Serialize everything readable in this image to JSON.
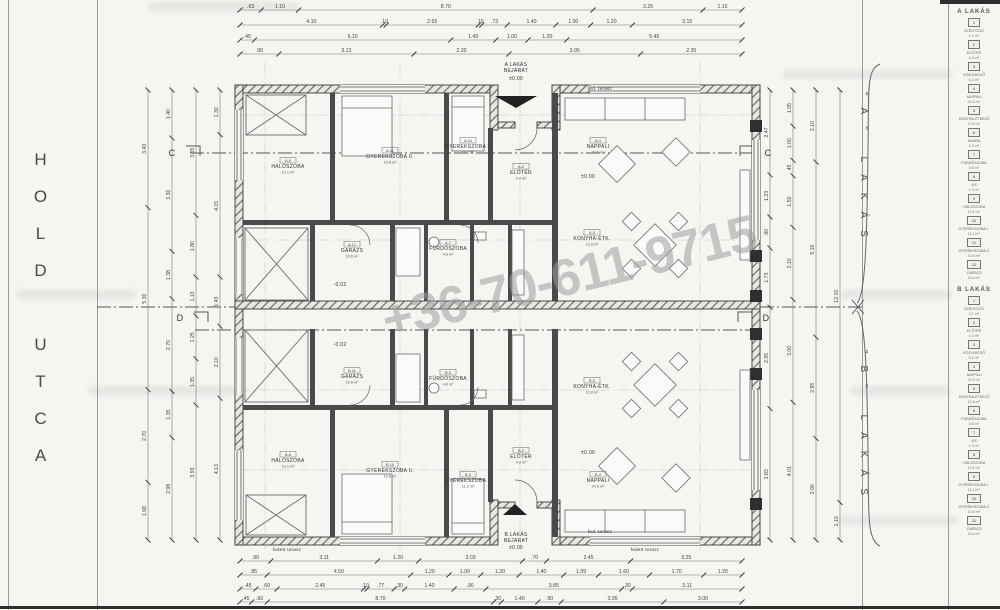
{
  "street": {
    "label": "HOLD UTCA"
  },
  "watermark": {
    "phone": "+36-70-611-9715"
  },
  "units": {
    "a_brace": "\"A\" LAKÁS",
    "b_brace": "\"B\" LAKÁS"
  },
  "legend": {
    "a_header": "A LAKÁS",
    "b_header": "B LAKÁS",
    "a_items": [
      {
        "no": "1",
        "name": "SZÉLFOGÓ",
        "area": "2.1 m²"
      },
      {
        "no": "2",
        "name": "ELŐTÉR",
        "area": "4.3 m²"
      },
      {
        "no": "3",
        "name": "KÖZLEKEDŐ",
        "area": "6.2 m²"
      },
      {
        "no": "4",
        "name": "NAPPALI",
        "area": "24.5 m²"
      },
      {
        "no": "5",
        "name": "KONYHA-ÉTKEZŐ",
        "area": "12.8 m²"
      },
      {
        "no": "6",
        "name": "KAMRA",
        "area": "1.5 m²"
      },
      {
        "no": "7",
        "name": "FÜRDŐSZOBA",
        "area": "4.6 m²"
      },
      {
        "no": "8",
        "name": "WC",
        "area": "1.5 m²"
      },
      {
        "no": "9",
        "name": "HÁLÓSZOBA",
        "area": "13.1 m²"
      },
      {
        "no": "10",
        "name": "GYEREKSZOBA I.",
        "area": "11.2 m²"
      },
      {
        "no": "11",
        "name": "GYEREKSZOBA II.",
        "area": "10.8 m²"
      },
      {
        "no": "12",
        "name": "GARÁZS",
        "area": "19.6 m²"
      }
    ],
    "b_items": [
      {
        "no": "1",
        "name": "SZÉLFOGÓ",
        "area": "2.1 m²"
      },
      {
        "no": "2",
        "name": "ELŐTÉR",
        "area": "4.3 m²"
      },
      {
        "no": "3",
        "name": "KÖZLEKEDŐ",
        "area": "6.2 m²"
      },
      {
        "no": "4",
        "name": "NAPPALI",
        "area": "24.5 m²"
      },
      {
        "no": "5",
        "name": "KONYHA-ÉTKEZŐ",
        "area": "12.8 m²"
      },
      {
        "no": "6",
        "name": "FÜRDŐSZOBA",
        "area": "4.6 m²"
      },
      {
        "no": "7",
        "name": "WC",
        "area": "1.5 m²"
      },
      {
        "no": "8",
        "name": "HÁLÓSZOBA",
        "area": "13.1 m²"
      },
      {
        "no": "9",
        "name": "GYEREKSZOBA I.",
        "area": "11.2 m²"
      },
      {
        "no": "10",
        "name": "GYEREKSZOBA II.",
        "area": "10.8 m²"
      },
      {
        "no": "11",
        "name": "GARÁZS",
        "area": "19.6 m²"
      }
    ]
  },
  "plan_texts": [
    {
      "name": "A LAKÁS",
      "x": 516,
      "y": 66
    },
    {
      "name": "BEJÁRAT",
      "x": 516,
      "y": 72
    },
    {
      "name": "±0.00",
      "x": 516,
      "y": 80
    },
    {
      "name": "B LAKÁS",
      "x": 516,
      "y": 536
    },
    {
      "name": "BEJÁRAT",
      "x": 516,
      "y": 542
    },
    {
      "name": "±0.00",
      "x": 516,
      "y": 549
    },
    {
      "num": "A-9",
      "name": "HÁLÓSZOBA",
      "sub": "13.1 m²",
      "x": 288,
      "y": 168
    },
    {
      "num": "A-11",
      "name": "GYEREKSZOBA II.",
      "sub": "10.8 m²",
      "x": 390,
      "y": 158
    },
    {
      "num": "A-10",
      "name": "GYEREKSZOBA I.",
      "sub": "11.2 m²",
      "x": 468,
      "y": 148
    },
    {
      "num": "A-2",
      "name": "ELŐTÉR",
      "sub": "4.3 m²",
      "x": 521,
      "y": 174
    },
    {
      "num": "A-4",
      "name": "NAPPALI",
      "sub": "24.5 m²",
      "x": 598,
      "y": 148
    },
    {
      "num": "A-12",
      "name": "GARÁZS",
      "sub": "19.6 m²",
      "x": 352,
      "y": 252
    },
    {
      "num": "A-7",
      "name": "FÜRDŐSZOBA",
      "sub": "4.6 m²",
      "x": 448,
      "y": 250
    },
    {
      "num": "A-5",
      "name": "KONYHA-ÉTK.",
      "sub": "12.8 m²",
      "x": 592,
      "y": 240
    },
    {
      "name": "±0.00",
      "x": 588,
      "y": 178
    },
    {
      "name": "-0.02",
      "x": 340,
      "y": 286
    },
    {
      "num": "B-8",
      "name": "HÁLÓSZOBA",
      "sub": "13.1 m²",
      "x": 288,
      "y": 462
    },
    {
      "num": "B-10",
      "name": "GYEREKSZOBA II.",
      "sub": "10.8 m²",
      "x": 390,
      "y": 472
    },
    {
      "num": "B-9",
      "name": "GYEREKSZOBA I.",
      "sub": "11.2 m²",
      "x": 468,
      "y": 482
    },
    {
      "num": "B-2",
      "name": "ELŐTÉR",
      "sub": "4.3 m²",
      "x": 521,
      "y": 458
    },
    {
      "num": "B-4",
      "name": "NAPPALI",
      "sub": "24.5 m²",
      "x": 598,
      "y": 482
    },
    {
      "num": "B-11",
      "name": "GARÁZS",
      "sub": "19.6 m²",
      "x": 352,
      "y": 378
    },
    {
      "num": "B-6",
      "name": "FÜRDŐSZOBA",
      "sub": "4.6 m²",
      "x": 448,
      "y": 380
    },
    {
      "num": "B-5",
      "name": "KONYHA-ÉTK.",
      "sub": "12.8 m²",
      "x": 592,
      "y": 388
    },
    {
      "name": "±0.00",
      "x": 588,
      "y": 454
    },
    {
      "name": "-0.02",
      "x": 340,
      "y": 346
    },
    {
      "name": "fed. terasz",
      "x": 600,
      "y": 90,
      "fs": 4.5
    },
    {
      "name": "fed. terasz",
      "x": 600,
      "y": 533,
      "fs": 4.5
    },
    {
      "name": "fedett terasz",
      "x": 287,
      "y": 551,
      "fs": 4.5
    },
    {
      "name": "fedett terasz",
      "x": 645,
      "y": 551,
      "fs": 4.5
    },
    {
      "name": "C",
      "x": 172,
      "y": 156,
      "fs": 9
    },
    {
      "name": "C",
      "x": 768,
      "y": 156,
      "fs": 9
    },
    {
      "name": "D",
      "x": 180,
      "y": 321,
      "fs": 9
    },
    {
      "name": "D",
      "x": 766,
      "y": 321,
      "fs": 9
    }
  ],
  "dimensions": {
    "top": {
      "x0": 240,
      "x1": 742,
      "rows": [
        {
          "y": 10,
          "values": [
            ".63",
            "1.10",
            "8.70",
            "3.25",
            "1.15"
          ]
        },
        {
          "y": 25,
          "values": [
            "4.10",
            ".10",
            "2.65",
            ".10",
            ".73",
            "1.40",
            "1.00",
            "1.20",
            "3.15"
          ]
        },
        {
          "y": 40,
          "values": [
            ".45",
            "6.10",
            "1.40",
            "1.00",
            "1.20",
            "5.45"
          ]
        },
        {
          "y": 54,
          "values": [
            ".90",
            "3.13",
            "2.20",
            "3.05",
            "2.35"
          ]
        }
      ]
    },
    "bottom": {
      "x0": 240,
      "x1": 742,
      "rows": [
        {
          "y": 561,
          "values": [
            ".90",
            "3.11",
            "1.20",
            "3.03",
            ".70",
            "2.45",
            "3.25"
          ]
        },
        {
          "y": 575,
          "values": [
            ".85",
            "4.50",
            "1.20",
            "1.00",
            "1.20",
            "1.40",
            "1.09",
            "1.60",
            "1.70",
            "1.20"
          ]
        },
        {
          "y": 589,
          "values": [
            ".45",
            ".60",
            "2.45",
            ".10",
            ".77",
            ".30",
            "1.40",
            ".90",
            "3.85",
            ".30",
            "3.11"
          ]
        },
        {
          "y": 602,
          "values": [
            ".45",
            ".60",
            "8.70",
            ".30",
            "1.40",
            ".90",
            "3.95",
            "3.00"
          ]
        }
      ]
    },
    "left": {
      "y0": 90,
      "y1": 540,
      "cols": [
        {
          "x": 148,
          "values": [
            "3.43",
            "5.30",
            "2.70",
            "1.68"
          ]
        },
        {
          "x": 172,
          "values": [
            "1.40",
            "3.30",
            "1.38",
            "2.70",
            "1.35",
            "2.98"
          ]
        },
        {
          "x": 196,
          "values": [
            "3.65",
            "1.80",
            "1.13",
            "1.25",
            "1.35",
            "3.93"
          ]
        },
        {
          "x": 220,
          "values": [
            "1.30",
            "4.15",
            "1.43",
            "2.10",
            "4.13"
          ]
        }
      ]
    },
    "right": {
      "y0": 90,
      "y1": 540,
      "cols": [
        {
          "x": 770,
          "values": [
            "2.47",
            "1.23",
            ".90",
            "1.73",
            "2.95",
            "3.83"
          ]
        },
        {
          "x": 793,
          "values": [
            "1.05",
            "1.00",
            ".45",
            "1.50",
            "2.10",
            "3.00",
            "4.01"
          ]
        },
        {
          "x": 816,
          "values": [
            "2.10",
            "5.10",
            "2.95",
            "2.96"
          ]
        },
        {
          "x": 840,
          "values": [
            "12.10",
            "1.10"
          ]
        }
      ]
    }
  },
  "colors": {
    "wall": "#3f3f3f",
    "line": "#555555",
    "dim_text": "#444444",
    "watermark": "#9e9e9e"
  }
}
